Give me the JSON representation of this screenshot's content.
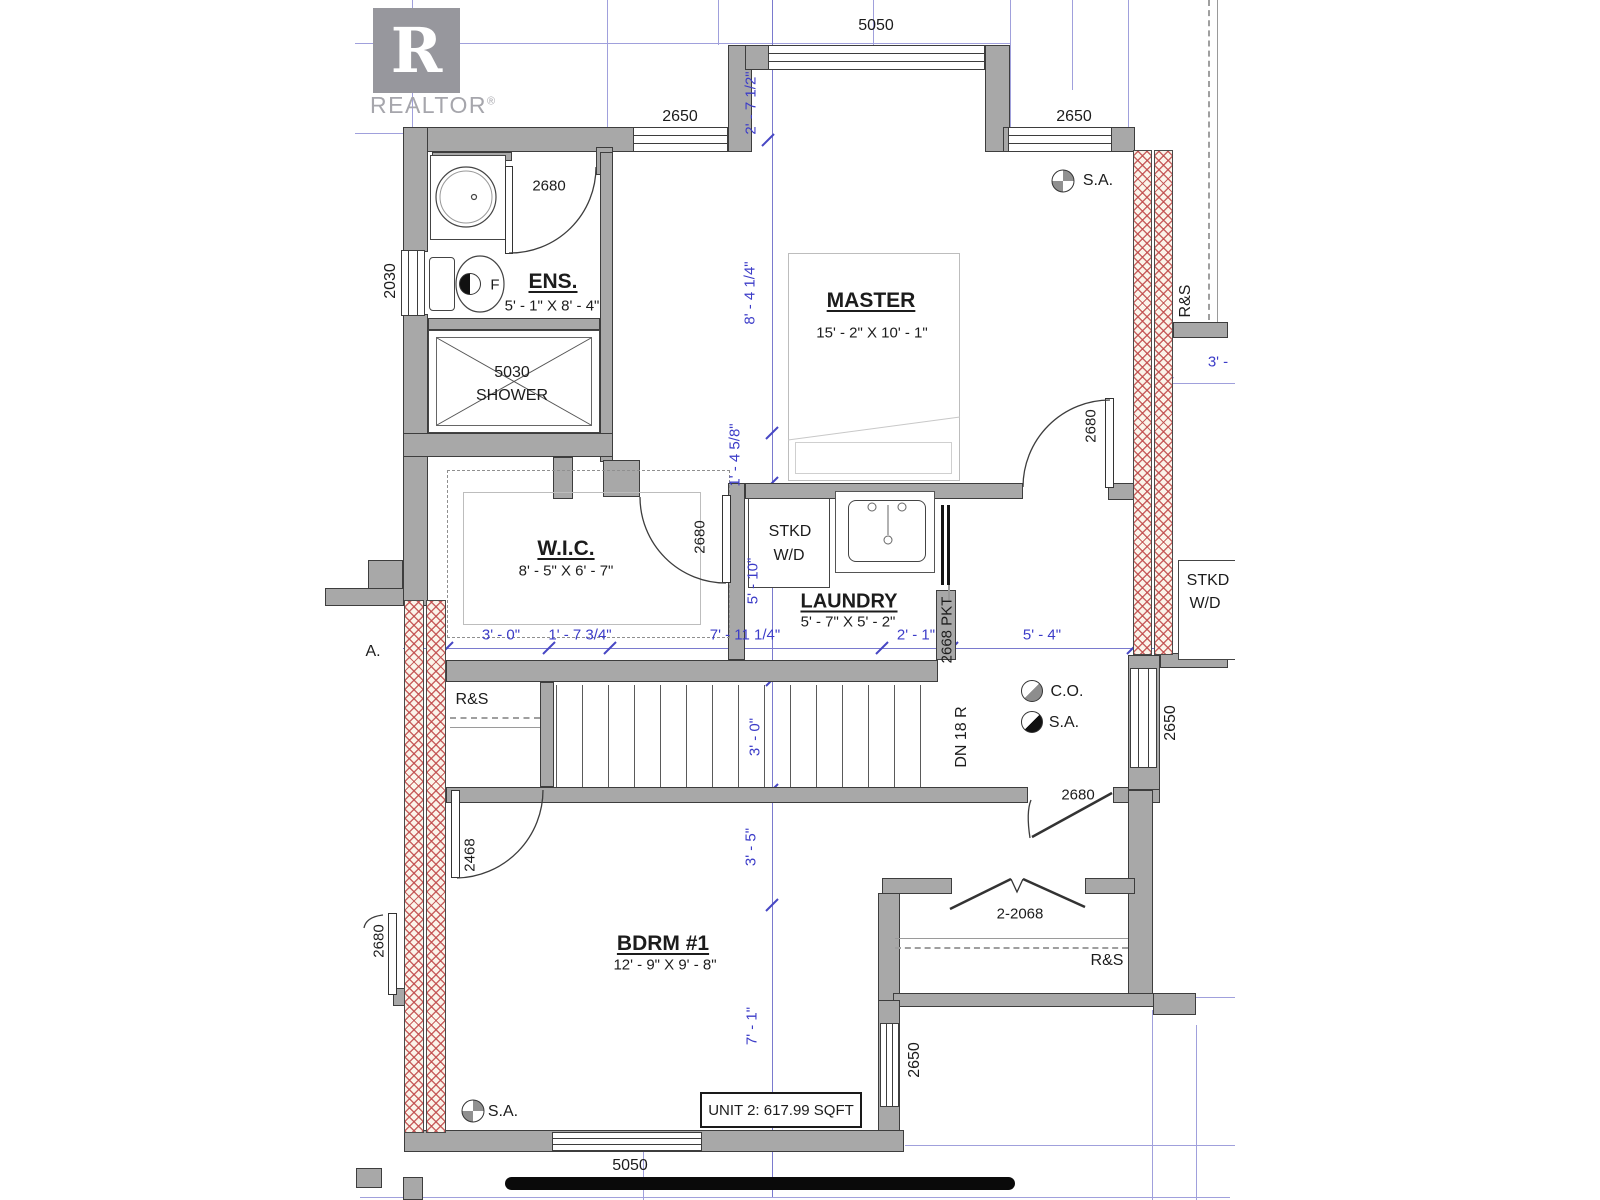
{
  "colors": {
    "dimension_blue": "#3c3cc8",
    "wall_gray": "#a8a8a8",
    "hatch_red": "#c04a4a",
    "line_dark": "#3d3d3d"
  },
  "watermark": {
    "monogram": "R",
    "brand": "REALTOR",
    "registered": "®"
  },
  "unit": {
    "area_label": "UNIT 2: 617.99 SQFT"
  },
  "rooms": {
    "master": {
      "name": "MASTER",
      "size": "15' - 2\" X 10' - 1\""
    },
    "ensuite": {
      "name": "ENS.",
      "size": "5' - 1\" X 8' - 4\""
    },
    "wic": {
      "name": "W.I.C.",
      "size": "8' - 5\" X 6' - 7\""
    },
    "laundry": {
      "name": "LAUNDRY",
      "size": "5' - 7\" X 5' - 2\""
    },
    "bdrm1": {
      "name": "BDRM #1",
      "size": "12' - 9\" X 9' - 8\""
    }
  },
  "fixtures": {
    "shower_code": "5030",
    "shower_label": "SHOWER",
    "stacked_wd_line1": "STKD",
    "stacked_wd_line2": "W/D",
    "toilet_tag": "F"
  },
  "stairs": {
    "label": "DN 18 R"
  },
  "safety": {
    "smoke_alarm": "S.A.",
    "carbon_monoxide": "C.O."
  },
  "closets": {
    "rod_shelf_stairs": "R&S",
    "rod_shelf_bdrm": "R&S"
  },
  "doors": {
    "ens": "2680",
    "wic": "2680",
    "master": "2680",
    "hall": "2680",
    "bdrm1": "2468",
    "closet_double": "2-2068",
    "laundry_pocket": "2668 PKT"
  },
  "windows": {
    "top_bay": "5050",
    "top_left": "2650",
    "top_right": "2650",
    "ens_side": "2030",
    "hall_side": "2650",
    "bdrm_side": "2650",
    "bdrm_bottom": "5050"
  },
  "dimensions": {
    "bay_depth": "2' - 7 1/2\"",
    "master_upper": "8' - 4 1/4\"",
    "master_lower": "1' - 4 5/8\"",
    "laundry_height": "5' - 10\"",
    "stair_width": "3' - 0\"",
    "nook_height": "3' - 5\"",
    "bdrm_height": "7' - 1\"",
    "chain_1": "3' - 0\"",
    "chain_2": "1' - 7 3/4\"",
    "chain_3": "7' - 11 1/4\"",
    "chain_4": "2' - 1\"",
    "chain_5": "5' - 4\""
  },
  "neighbor": {
    "stacked_wd_line1": "STKD",
    "stacked_wd_line2": "W/D",
    "rod_shelf": "R&S",
    "partial_dim": "3' -",
    "partial_smoke_alarm": "A.",
    "door": "2680"
  }
}
